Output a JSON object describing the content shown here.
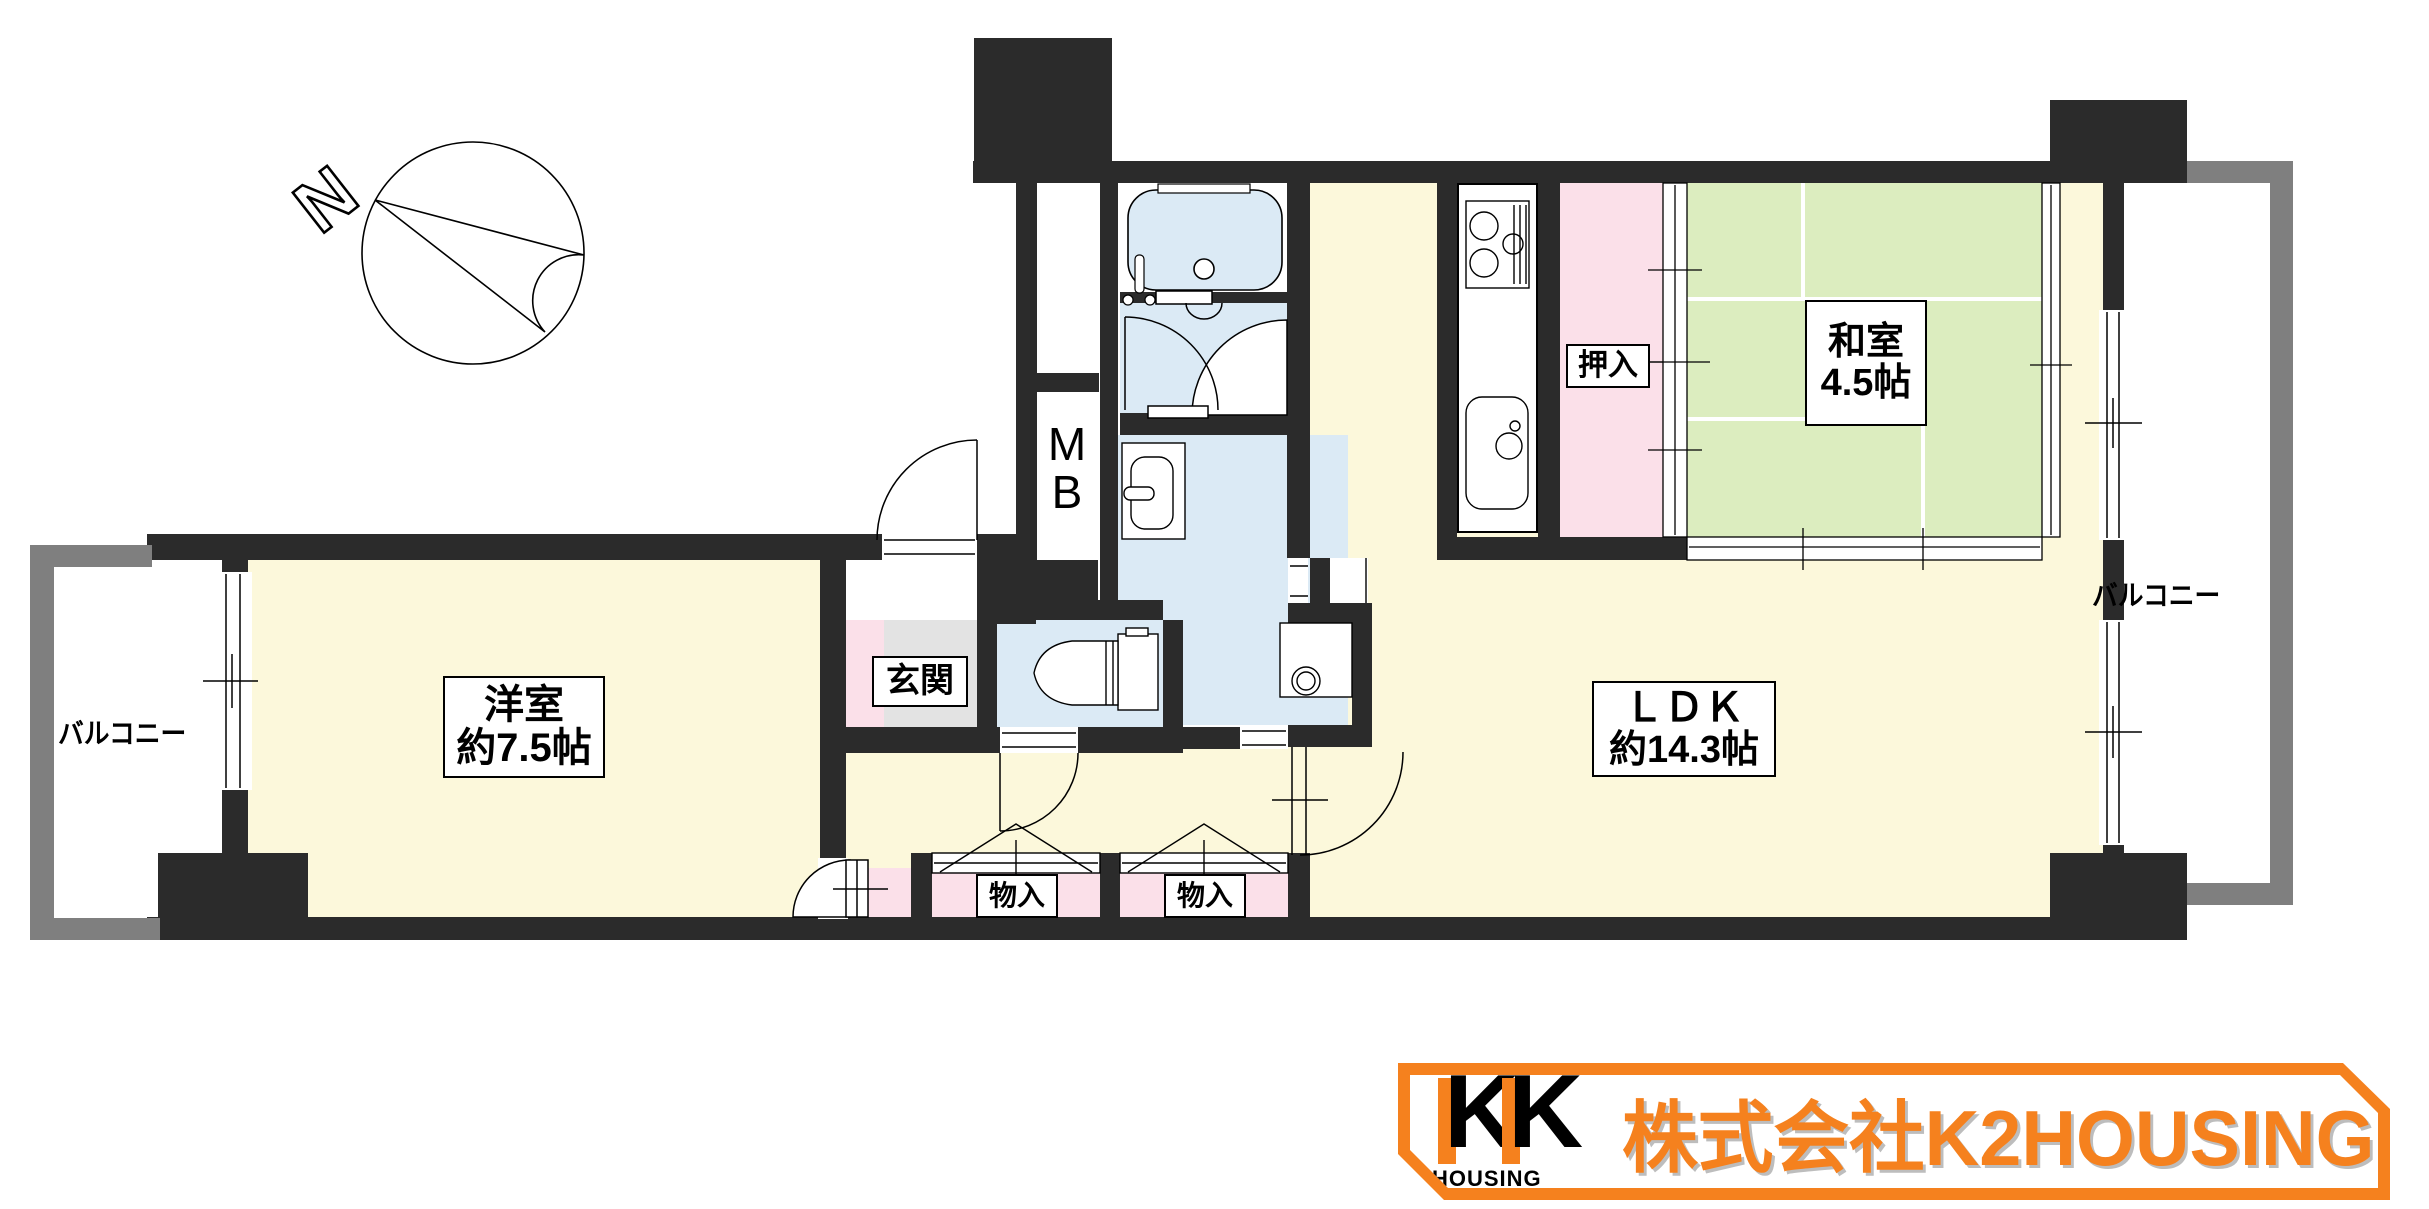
{
  "compass": {
    "north_label": "N"
  },
  "rooms": {
    "western_room": {
      "name": "洋室",
      "size": "約7.5帖"
    },
    "ldk": {
      "name": "ＬＤＫ",
      "size": "約14.3帖"
    },
    "japanese_room": {
      "name": "和室",
      "size": "4.5帖"
    },
    "entrance": {
      "name": "玄関"
    },
    "oshiire": {
      "name": "押入"
    },
    "storage_left": {
      "name": "物入"
    },
    "storage_right": {
      "name": "物入"
    },
    "meter_box": {
      "line1": "M",
      "line2": "B"
    },
    "balcony_left": {
      "name": "バルコニー"
    },
    "balcony_right": {
      "name": "バルコニー"
    }
  },
  "colors": {
    "wall": "#2b2b2b",
    "balcony_wall": "#7f7f7f",
    "flooring_yellow": "#FCF8DB",
    "tatami_green": "#DCEDBF",
    "closet_pink": "#FBE0E9",
    "wet_area_blue": "#DBEAF5",
    "entrance_gray": "#E3E3E3",
    "logo_orange": "#F5811E"
  },
  "logo": {
    "mark_letter": "K",
    "mark_sub": "HOUSING",
    "company": "株式会社K2HOUSING"
  }
}
